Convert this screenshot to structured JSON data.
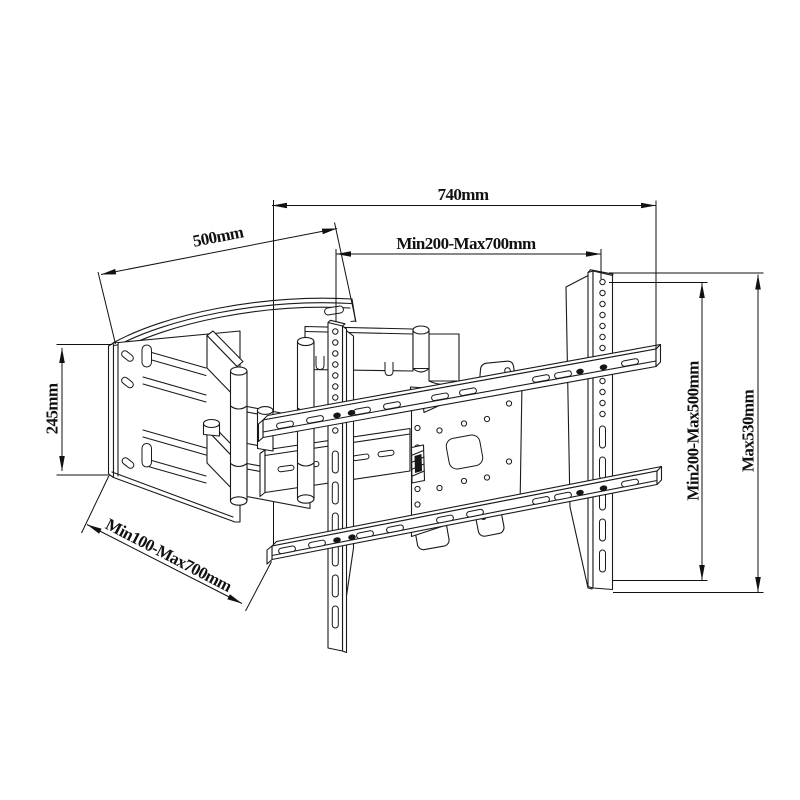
{
  "document": {
    "type": "technical-drawing",
    "subject": "Full-motion articulating TV wall mount bracket, dimensioned perspective line drawing",
    "background_color": "#ffffff",
    "line_color": "#1a1a1a"
  },
  "dimensions": {
    "top_width": "740mm",
    "wall_plate_width": "500mm",
    "horizontal_adjust": "Min200-Max700mm",
    "wall_plate_height": "245mm",
    "extension_range": "Min100-Max700mm",
    "vertical_adjust": "Min200-Max500mm",
    "bracket_max_height": "Max530mm"
  }
}
